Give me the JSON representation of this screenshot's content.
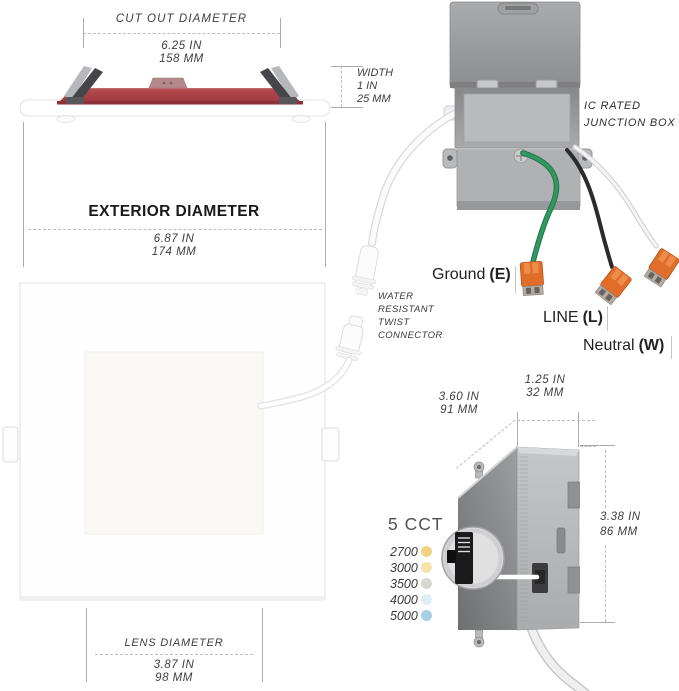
{
  "side_view": {
    "cutout": {
      "label": "CUT OUT DIAMETER",
      "inches": "6.25 IN",
      "mm": "158 MM"
    },
    "width": {
      "label": "WIDTH",
      "inches": "1 IN",
      "mm": "25 MM"
    },
    "exterior": {
      "label": "EXTERIOR DIAMETER",
      "inches": "6.87 IN",
      "mm": "174 MM"
    }
  },
  "front_view": {
    "lens": {
      "label": "LENS DIAMETER",
      "inches": "3.87 IN",
      "mm": "98 MM"
    }
  },
  "junction_box": {
    "label": {
      "line1": "IC RATED",
      "line2": "JUNCTION BOX"
    },
    "connector_note": {
      "line1": "WATER",
      "line2": "RESISTANT",
      "line3": "TWIST",
      "line4": "CONNECTOR"
    },
    "wires": {
      "ground": {
        "name": "Ground",
        "code": "(E)"
      },
      "line": {
        "name": "LINE",
        "code": "(L)"
      },
      "neutral": {
        "name": "Neutral",
        "code": "(W)"
      }
    },
    "dimensions": {
      "depth": {
        "inches": "3.60 IN",
        "mm": "91 MM"
      },
      "width": {
        "inches": "1.25 IN",
        "mm": "32 MM"
      },
      "height": {
        "inches": "3.38 IN",
        "mm": "86 MM"
      }
    }
  },
  "cct": {
    "title": "5 CCT",
    "options": [
      {
        "kelvin": "2700",
        "color": "#f1d185"
      },
      {
        "kelvin": "3000",
        "color": "#f5e3a9"
      },
      {
        "kelvin": "3500",
        "color": "#d5dad1"
      },
      {
        "kelvin": "4000",
        "color": "#e1edf4"
      },
      {
        "kelvin": "5000",
        "color": "#a8cee5"
      }
    ]
  },
  "colors": {
    "heatsink_red": "#a63a40",
    "wire_green": "#2f9960",
    "wire_black": "#2b2b2b",
    "wire_white": "#f0f0f0",
    "connector_orange": "#e06e2a"
  }
}
